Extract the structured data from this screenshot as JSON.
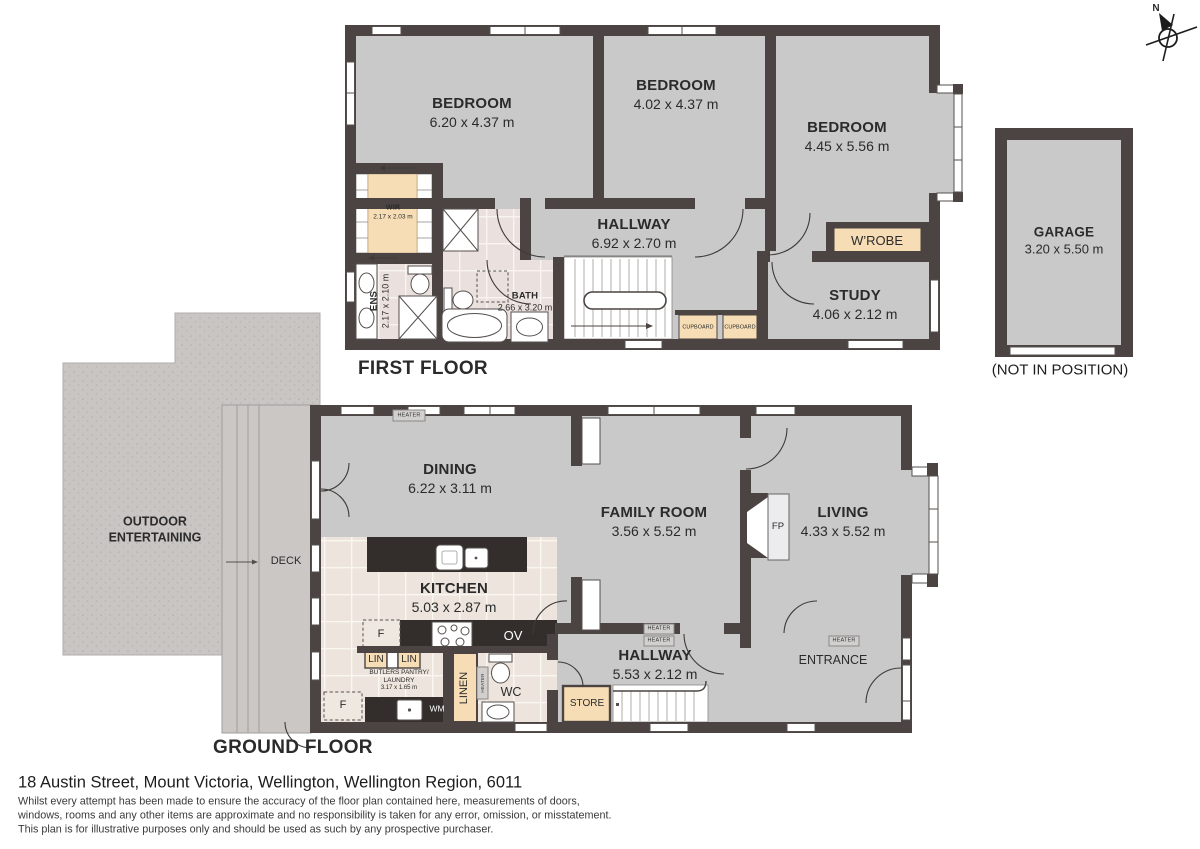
{
  "compass": {
    "north": "N"
  },
  "first_floor": {
    "title": "FIRST FLOOR",
    "rooms": {
      "bedroom1": {
        "name": "BEDROOM",
        "dims": "6.20 x 4.37 m"
      },
      "bedroom2": {
        "name": "BEDROOM",
        "dims": "4.02 x 4.37 m"
      },
      "bedroom3": {
        "name": "BEDROOM",
        "dims": "4.45 x 5.56 m"
      },
      "hallway": {
        "name": "HALLWAY",
        "dims": "6.92 x 2.70 m"
      },
      "wir": {
        "name": "WIR",
        "dims": "2.17 x 2.03 m"
      },
      "ens": {
        "name": "ENS",
        "dims": "2.17 x 2.10 m"
      },
      "bath": {
        "name": "BATH",
        "dims": "2.66 x 3.20 m"
      },
      "study": {
        "name": "STUDY",
        "dims": "4.06 x 2.12 m"
      },
      "wardrobe": {
        "name": "W’ROBE"
      },
      "cupboard": {
        "name": "CUPBOARD"
      }
    }
  },
  "garage": {
    "name": "GARAGE",
    "dims": "3.20 x 5.50 m",
    "note": "(NOT IN POSITION)"
  },
  "ground_floor": {
    "title": "GROUND FLOOR",
    "rooms": {
      "dining": {
        "name": "DINING",
        "dims": "6.22 x 3.11 m"
      },
      "family_room": {
        "name": "FAMILY ROOM",
        "dims": "3.56 x 5.52 m"
      },
      "living": {
        "name": "LIVING",
        "dims": "4.33 x 5.52 m"
      },
      "kitchen": {
        "name": "KITCHEN",
        "dims": "5.03 x 2.87 m"
      },
      "hallway": {
        "name": "HALLWAY",
        "dims": "5.53 x 2.12 m"
      },
      "entrance": {
        "name": "ENTRANCE"
      },
      "butlers_pantry": {
        "line1": "BUTLERS PANTRY/",
        "line2": "LAUNDRY",
        "dims": "3.17 x 1.65 m"
      },
      "wc": {
        "name": "WC"
      },
      "linen": {
        "name": "LINEN"
      },
      "store": {
        "name": "STORE"
      },
      "outdoor": {
        "line1": "OUTDOOR",
        "line2": "ENTERTAINING"
      },
      "deck": {
        "name": "DECK"
      }
    },
    "fixtures": {
      "heater": "HEATER",
      "fridge": "F",
      "oven": "OV",
      "washing_machine": "WM",
      "linen_cupboard": "LIN",
      "fireplace": "FP"
    }
  },
  "colors": {
    "wall": "#4b4442",
    "floor": "#c9c9ca",
    "joinery": "#f6ddb6",
    "tile_bath": "#eae0dd",
    "tile_kitchen": "#ede5dd",
    "outdoor": "#c8c5c3"
  },
  "footer": {
    "address": "18 Austin Street, Mount Victoria, Wellington, Wellington Region, 6011",
    "disclaimer1": "Whilst every attempt has been made to ensure the accuracy of the floor plan contained here, measurements of doors,",
    "disclaimer2": "windows, rooms and any other items are approximate and no responsibility is taken for any error, omission, or misstatement.",
    "disclaimer3": "This plan is for illustrative purposes only and should be used as such by any prospective purchaser."
  }
}
